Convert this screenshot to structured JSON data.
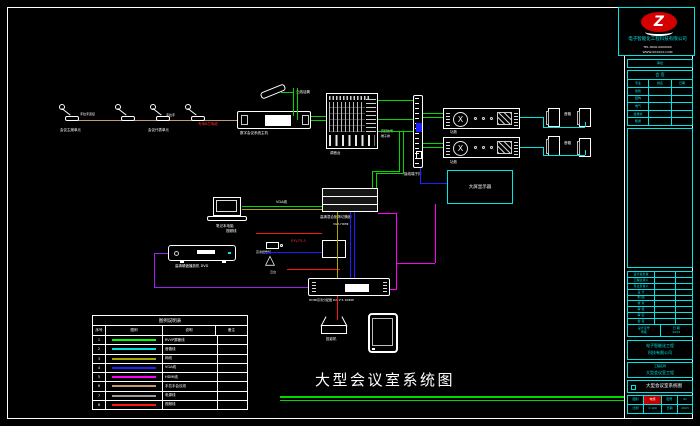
{
  "palette": {
    "background": "#000000",
    "frame": "#ffffff",
    "cyan": "#00e5e5",
    "green": "#00d800",
    "olive": "#a8a800",
    "blue": "#2020ff",
    "magenta": "#ff00ff",
    "purple": "#a020f0",
    "tan": "#c49a6c",
    "gray": "#9a9a9a",
    "red": "#ff1414",
    "logo_red": "#d40000"
  },
  "logo": {
    "letter": "Z",
    "company": "电子智能化工程科技有限公司",
    "line1": "TEL 0000-0000000",
    "line2": "WWW.XXXXXX.COM"
  },
  "sheet": {
    "main_title": "大型会议室系统图"
  },
  "labels": {
    "mic_group1": "会议主席单元",
    "mic_group2": "会议代表单元",
    "mic_link1": "手拉手连接",
    "mic_link2": "手拉手",
    "mic_cable": "专用8芯电缆",
    "wireless_mic": "无线话筒",
    "conf_host": "数字会议系统主机",
    "mixer": "调音台",
    "mixer_note1": "音频信号",
    "mixer_note2": "端子排",
    "terminal": "接线端子排",
    "amp": "功放",
    "speaker": "音箱",
    "display": "大屏显示器",
    "matrix": "高清混合矩阵切换器",
    "matrix_sub": "VGA  HDMI",
    "laptop": "笔记本电脑",
    "vga": "VGA线",
    "video": "视频线",
    "syv": "SYV75-5",
    "camera": "高清摄像机",
    "pantilt": "云台",
    "dvd": "高清硬盘播放机 DVD",
    "splitter": "HDMI高清分配器 DA 1*4 1080P",
    "projector": "投影机"
  },
  "legend": {
    "title": "图例说明表",
    "headers": [
      "序号",
      "图例",
      "说明",
      "备注"
    ],
    "rows": [
      {
        "num": "1",
        "color": "#00ff00",
        "desc": "RVVP屏蔽线"
      },
      {
        "num": "2",
        "color": "#00e5e5",
        "desc": "音箱线"
      },
      {
        "num": "3",
        "color": "#a8a800",
        "desc": "网线"
      },
      {
        "num": "4",
        "color": "#2020ff",
        "desc": "VGA线"
      },
      {
        "num": "5",
        "color": "#ff00ff",
        "desc": "HDMI线"
      },
      {
        "num": "6",
        "color": "#c49a6c",
        "desc": "手拉手会议线"
      },
      {
        "num": "7",
        "color": "#9a9a9a",
        "desc": "电源线"
      },
      {
        "num": "8",
        "color": "#ff1414",
        "desc": "视频线"
      }
    ]
  },
  "titleblock": {
    "approve": "审批",
    "huiqian": "会 签",
    "cols": [
      "专业",
      "姓名",
      "日期"
    ],
    "disciplines": [
      "建筑",
      "结构",
      "电气",
      "给排水",
      "暖通"
    ],
    "roles": [
      "设计总负责",
      "工程主持人",
      "专业负责人",
      "设 计",
      "制 图",
      "校 对",
      "审 核",
      "审 定",
      "会 签"
    ],
    "cert_label": "设计证号",
    "cert_value": "甲级",
    "date_label": "日 期",
    "date_value": "2023",
    "company1": "电子智能化工程",
    "company2": "科技有限公司",
    "project_label": "工程名称",
    "project_name": "大型会议室工程",
    "sheet_title": "大型会议室系统图",
    "b1": "图别",
    "b2": "电施",
    "b3": "图号",
    "b4": "01",
    "b5": "比例",
    "b6": "1:100",
    "b7": "日期",
    "b8": "2023"
  }
}
